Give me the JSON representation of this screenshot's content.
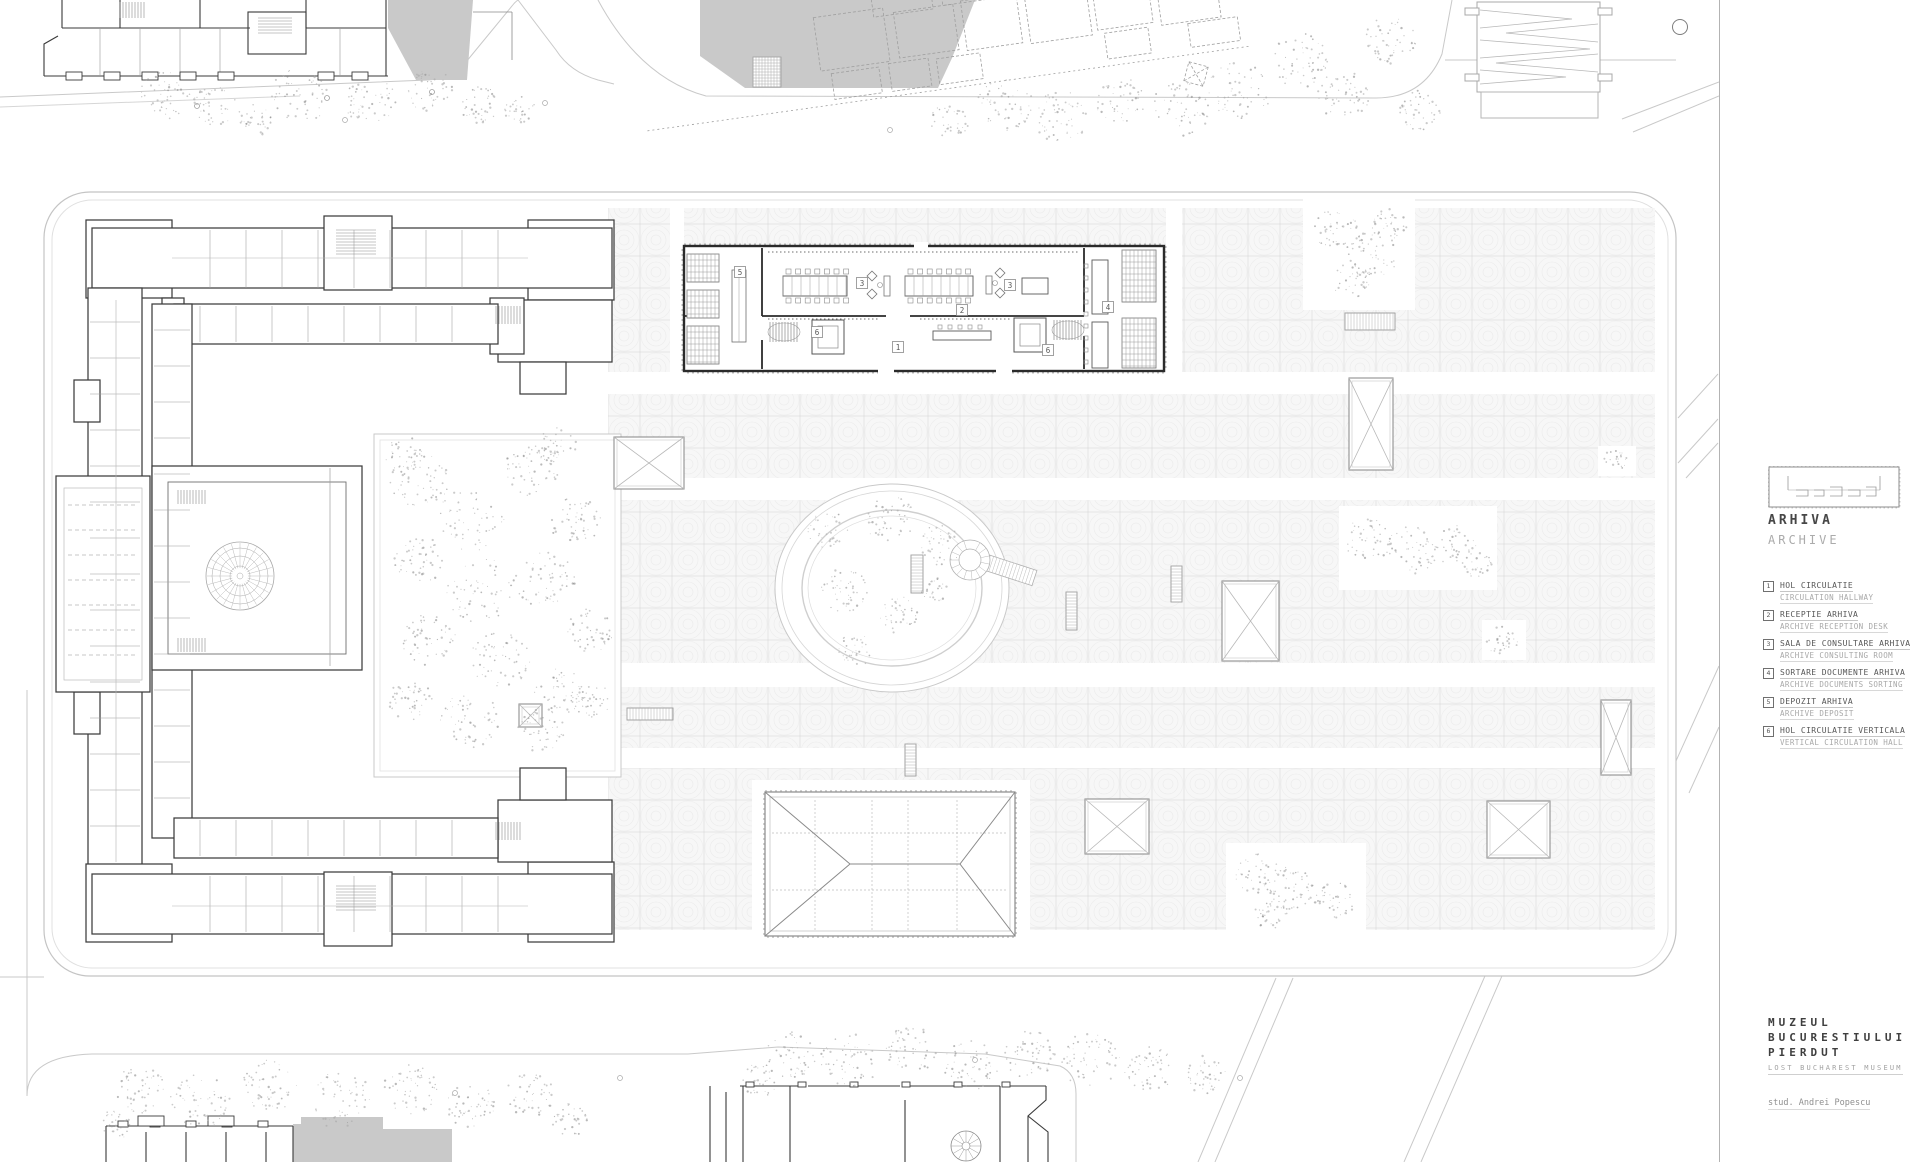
{
  "sidebar": {
    "title_ro": "ARHIVA",
    "title_en": "ARCHIVE",
    "legend": [
      {
        "num": "1",
        "ro": "HOL CIRCULATIE",
        "en": "CIRCULATION HALLWAY"
      },
      {
        "num": "2",
        "ro": "RECEPTIE ARHIVA",
        "en": "ARCHIVE RECEPTION DESK"
      },
      {
        "num": "3",
        "ro": "SALA DE CONSULTARE ARHIVA",
        "en": "ARCHIVE CONSULTING ROOM"
      },
      {
        "num": "4",
        "ro": "SORTARE DOCUMENTE ARHIVA",
        "en": "ARCHIVE DOCUMENTS SORTING"
      },
      {
        "num": "5",
        "ro": "DEPOZIT ARHIVA",
        "en": "ARCHIVE DEPOSIT"
      },
      {
        "num": "6",
        "ro": "HOL CIRCULATIE VERTICALA",
        "en": "VERTICAL CIRCULATION HALL"
      }
    ],
    "project": {
      "line1": "MUZEUL",
      "line2": "BUCURESTIULUI",
      "line3": "PIERDUT",
      "subtitle": "LOST BUCHAREST MUSEUM",
      "author": "stud. Andrei Popescu"
    }
  },
  "plan": {
    "room_labels": [
      {
        "num": "5",
        "x": 740,
        "y": 272
      },
      {
        "num": "3",
        "x": 862,
        "y": 283
      },
      {
        "num": "3",
        "x": 1010,
        "y": 285
      },
      {
        "num": "2",
        "x": 962,
        "y": 310
      },
      {
        "num": "1",
        "x": 898,
        "y": 347
      },
      {
        "num": "6",
        "x": 817,
        "y": 332
      },
      {
        "num": "6",
        "x": 1048,
        "y": 350
      },
      {
        "num": "4",
        "x": 1108,
        "y": 307
      }
    ],
    "colors": {
      "building_mass": "#c9c9c9",
      "wall": "#2e2e2e",
      "street": "#c9c9c9",
      "tile_line": "#dcdcdc",
      "tree": "#9a9a9a"
    }
  }
}
